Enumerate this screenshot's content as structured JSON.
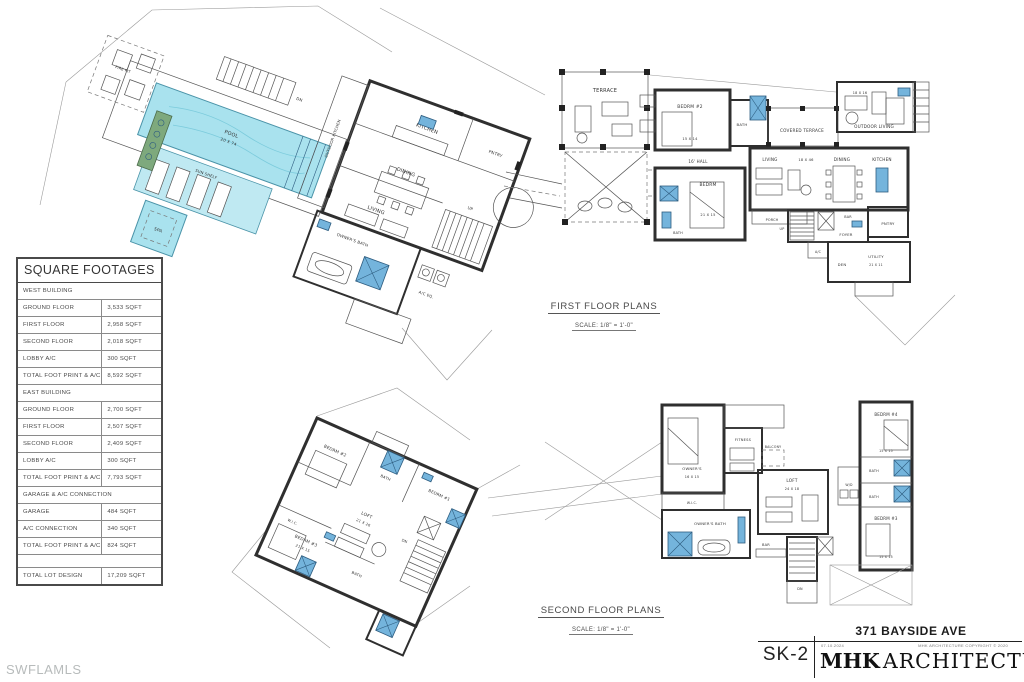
{
  "watermark": "SWFLAMLS",
  "colors": {
    "pool_fill": "#a9e2ee",
    "fixture_blue": "#74b4dc",
    "planter_green": "#7ea97d",
    "ink": "#2f2f2f",
    "watermark_gray": "#b7bbbb"
  },
  "table": {
    "title": "SQUARE FOOTAGES",
    "rows": [
      {
        "type": "section",
        "label": "WEST BUILDING",
        "value": ""
      },
      {
        "type": "data",
        "label": "GROUND FLOOR",
        "value": "3,533 SQFT"
      },
      {
        "type": "data",
        "label": "FIRST FLOOR",
        "value": "2,958 SQFT"
      },
      {
        "type": "data",
        "label": "SECOND FLOOR",
        "value": "2,018 SQFT"
      },
      {
        "type": "data",
        "label": "LOBBY A/C",
        "value": "300 SQFT"
      },
      {
        "type": "data",
        "label": "TOTAL FOOT PRINT & A/C",
        "value": "8,592 SQFT"
      },
      {
        "type": "section",
        "label": "EAST BUILDING",
        "value": ""
      },
      {
        "type": "data",
        "label": "GROUND FLOOR",
        "value": "2,700 SQFT"
      },
      {
        "type": "data",
        "label": "FIRST FLOOR",
        "value": "2,507 SQFT"
      },
      {
        "type": "data",
        "label": "SECOND FLOOR",
        "value": "2,409 SQFT"
      },
      {
        "type": "data",
        "label": "LOBBY A/C",
        "value": "300 SQFT"
      },
      {
        "type": "data",
        "label": "TOTAL FOOT PRINT & A/C",
        "value": "7,793 SQFT"
      },
      {
        "type": "section",
        "label": "GARAGE & A/C CONNECTION",
        "value": ""
      },
      {
        "type": "data",
        "label": "GARAGE",
        "value": "484 SQFT"
      },
      {
        "type": "data",
        "label": "A/C CONNECTION",
        "value": "340 SQFT"
      },
      {
        "type": "data",
        "label": "TOTAL FOOT PRINT & A/C",
        "value": "824 SQFT"
      },
      {
        "type": "empty",
        "label": "",
        "value": ""
      },
      {
        "type": "data",
        "label": "TOTAL LOT DESIGN",
        "value": "17,209 SQFT"
      }
    ]
  },
  "plan_labels": {
    "first": {
      "title": "FIRST FLOOR PLANS",
      "scale": "SCALE: 1/8\" = 1'-0\""
    },
    "second": {
      "title": "SECOND FLOOR PLANS",
      "scale": "SCALE: 1/8\" = 1'-0\""
    }
  },
  "title_block": {
    "address": "371 BAYSIDE AVE",
    "sheet_number": "SK-2",
    "date": "07.10.2024",
    "copyright": "MHK ARCHITECTURE COPYRIGHT © 2020",
    "firm_initials": "MHK",
    "firm_name": "ARCHITECTURE"
  },
  "plans": {
    "west_first": {
      "rooms": {
        "fire_pit": "FIRE PIT",
        "pool": "POOL",
        "pool_dim": "20 X 74",
        "sun_shelf": "SUN SHELF",
        "spa": "SPA",
        "dn": "DN",
        "outdoor_kitchen": "OUTDOOR KITCHEN",
        "kitchen": "KITCHEN",
        "pantry": "PNTRY",
        "dining": "DINING",
        "living": "LIVING",
        "up": "UP",
        "owners_bath": "OWNER'S BATH",
        "ac": "A/C EQ."
      }
    },
    "terrace": {
      "label": "TERRACE"
    },
    "east_first": {
      "rooms": {
        "bedrm2": "BEDRM #2",
        "bedrm2_dim": "15 X 14",
        "bath": "BATH",
        "hall": "16' HALL",
        "bedrm": "BEDRM",
        "bedrm_dim": "21 X 15",
        "bath2": "BATH",
        "covered_terrace": "COVERED TERRACE",
        "outdoor_living": "OUTDOOR LIVING",
        "outdoor_dim": "18 X 16",
        "living": "LIVING",
        "living_dim": "18 X 46",
        "dining": "DINING",
        "kitchen": "KITCHEN",
        "porch": "PORCH",
        "bar": "BAR",
        "foyer": "FOYER",
        "pantry": "PNTRY",
        "ac": "A/C",
        "den": "DEN",
        "utility": "UTILITY",
        "utility_dim": "21 X 11",
        "up": "UP"
      }
    },
    "west_second": {
      "rooms": {
        "bedrm2": "BEDRM #2",
        "bath1": "BATH",
        "bedrm1": "BEDRM #1",
        "loft": "LOFT",
        "loft_dim": "21 X 26",
        "wic": "W.I.C.",
        "bedrm3": "BEDRM #3",
        "bedrm3_dim": "21 X 15",
        "bath2": "BATH",
        "dn": "DN"
      }
    },
    "east_second": {
      "rooms": {
        "owners": "OWNER'S",
        "owners_dim": "16 X 15",
        "fitness": "FITNESS",
        "balcony": "BALCONY",
        "loft": "LOFT",
        "loft_dim": "24 X 18",
        "wic": "W.I.C.",
        "owners_bath": "OWNER'S BATH",
        "bar": "BAR",
        "dn": "DN",
        "bedrm4": "BEDRM #4",
        "bedrm4_dim": "15 X 15",
        "bath1": "BATH",
        "bath2": "BATH",
        "bedrm3": "BEDRM #3",
        "bedrm3_dim": "15 X 15",
        "wd": "W/D"
      }
    }
  }
}
